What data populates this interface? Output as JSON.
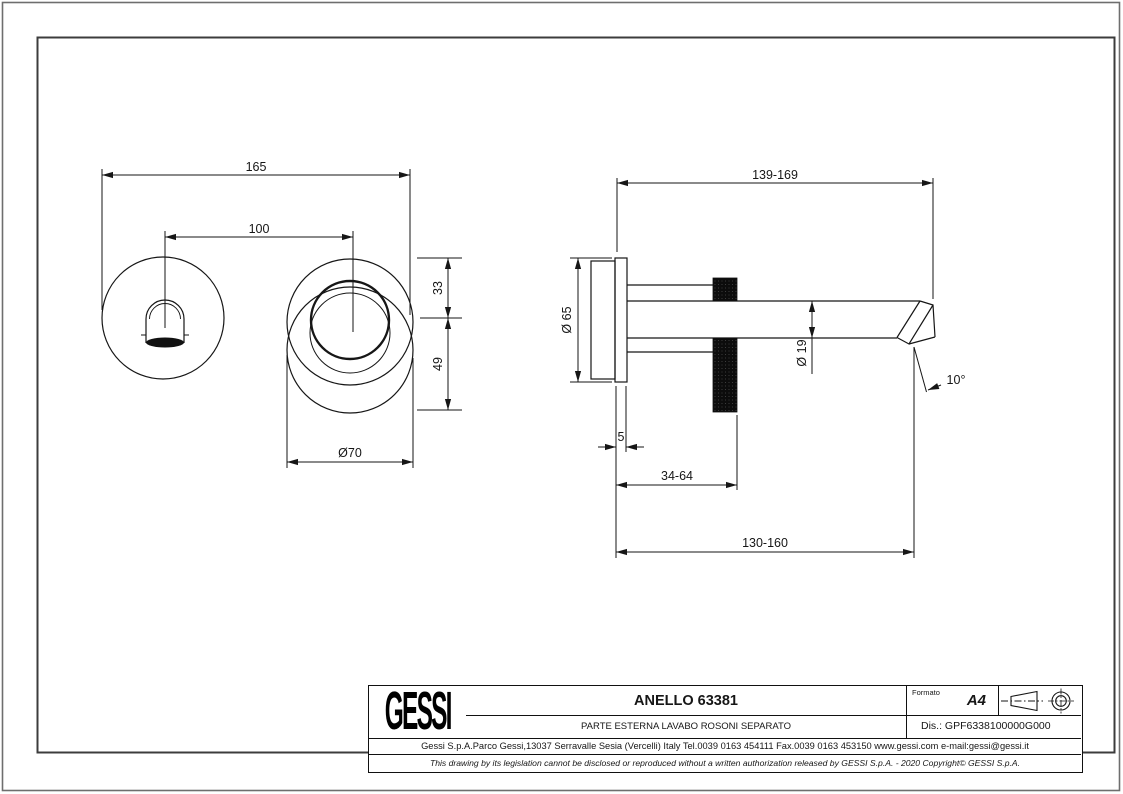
{
  "colors": {
    "line": "#161616",
    "frame_outer": "#6e6e6e",
    "frame_inner": "#3c3c3c",
    "background": "#ffffff",
    "knurl_fill": "#0c0c0c"
  },
  "drawing": {
    "dimensions": {
      "overall_width": "165",
      "hole_spacing": "100",
      "upper_offset": "33",
      "lower_offset": "49",
      "ring_diameter": "Ø70",
      "spout_reach_range": "139-169",
      "rosette_diameter": "Ø 65",
      "spout_tube_diameter": "Ø 19",
      "rosette_thickness": "5",
      "ring_position_range": "34-64",
      "outlet_distance_range": "130-160",
      "outlet_angle": "10°"
    }
  },
  "title_block": {
    "logo": "GESSI",
    "title": "ANELLO 63381",
    "subtitle": "PARTE ESTERNA LAVABO ROSONI SEPARATO",
    "format_label": "Formato",
    "format_value": "A4",
    "drawing_code": "Dis.: GPF6338100000G000",
    "company_line": "Gessi S.p.A.Parco Gessi,13037 Serravalle Sesia (Vercelli) Italy Tel.0039 0163 454111 Fax.0039 0163 453150 www.gessi.com e-mail:gessi@gessi.it",
    "legal_line": "This drawing by its legislation cannot be disclosed or reproduced without a written authorization released by GESSI S.p.A. - 2020 Copyright© GESSI S.p.A."
  }
}
